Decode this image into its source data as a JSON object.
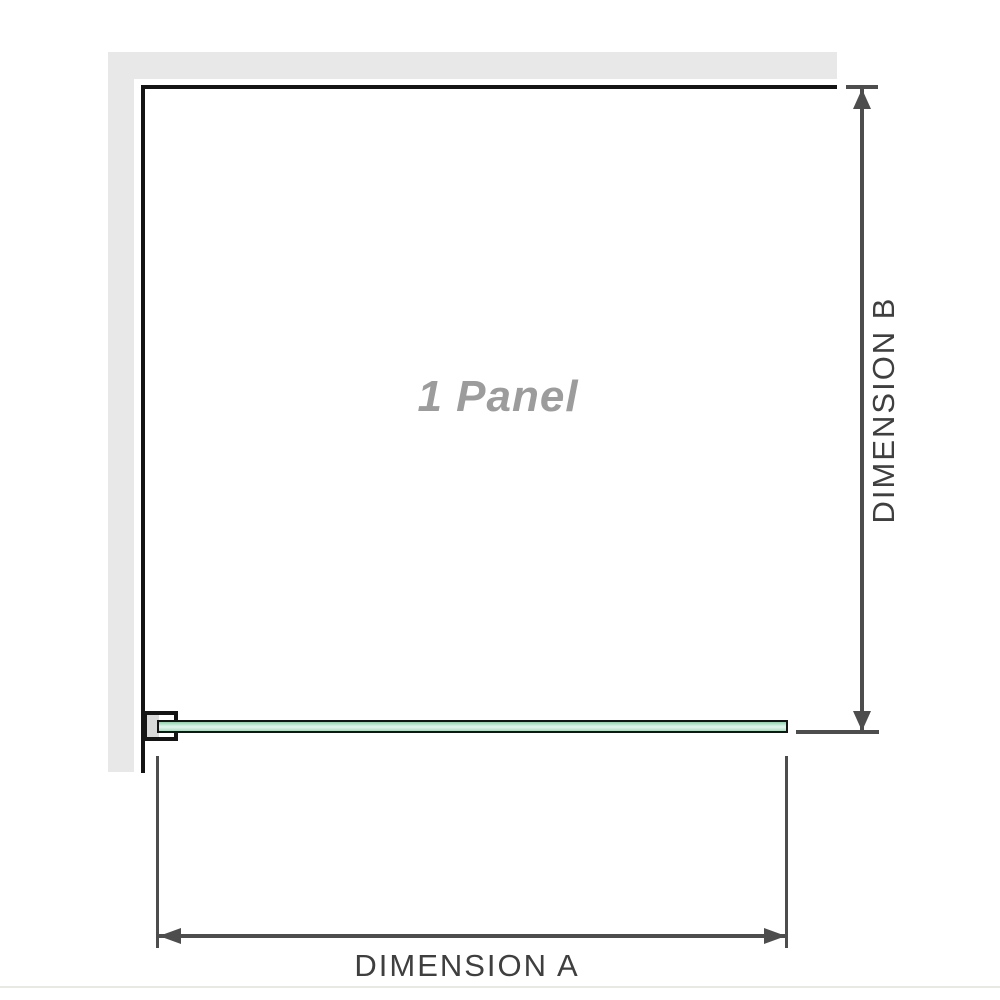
{
  "diagram": {
    "panel_label": "1 Panel",
    "dimension_a_label": "DIMENSION A",
    "dimension_b_label": "DIMENSION B"
  },
  "colors": {
    "wall-gray": "#e8e8e8",
    "outline-black": "#141414",
    "dim-gray": "#4d4d4d",
    "label-gray": "#3f3f3f",
    "panel-label-gray": "#9c9c9c",
    "glass-top": "#8ecfad",
    "glass-light": "#e4f5ec",
    "glass-bottom": "#a8dcc0",
    "bracket-pad": "#d9d9d9",
    "divider": "#e9e8e3"
  }
}
